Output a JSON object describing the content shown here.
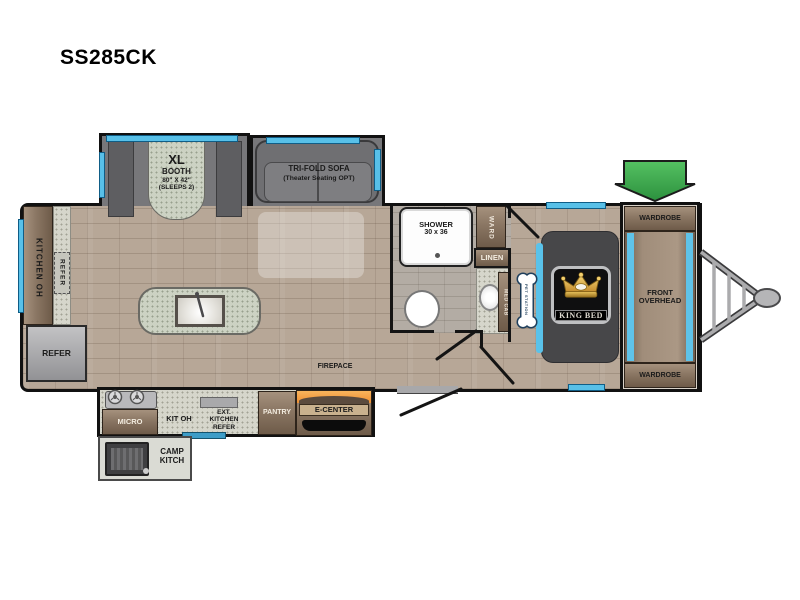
{
  "title": "SS285CK",
  "colors": {
    "window_blue": "#58c0e8",
    "docking_green": "#3fae49",
    "fireplace_orange": "#f5a04c",
    "crown_gold": "#d9a93c",
    "step_blue": "#3d9dc8",
    "wall_black": "#141414"
  },
  "plan": {
    "booth": {
      "l1": "XL",
      "l2": "BOOTH",
      "l3": "80\" X 42\"",
      "l4": "(SLEEPS 2)"
    },
    "sofa": {
      "l1": "TRI-FOLD SOFA",
      "l2": "(Theater Seating OPT)"
    },
    "shower": {
      "l1": "SHOWER",
      "l2": "30 x 36"
    },
    "ward": "WARD",
    "linen": "LINEN",
    "med_cab": "MED CAB",
    "pet_station": "PET STATION",
    "king_bed": "KING BED",
    "front_overhead": {
      "l1": "FRONT",
      "l2": "OVERHEAD"
    },
    "wardrobe_top": "WARDROBE",
    "wardrobe_bottom": "WARDROBE",
    "docking": {
      "l1": "DOCKING",
      "l2": "STATION"
    },
    "kitchen_oh": "KITCHEN OH",
    "refer_counter": "REFER",
    "refer_main": "REFER",
    "micro": "MICRO",
    "kit_oh": "KIT OH",
    "ext_kitchen": {
      "l1": "EXT.",
      "l2": "KITCHEN",
      "l3": "REFER"
    },
    "pantry": "PANTRY",
    "e_center": "E-CENTER",
    "fireplace": "FIREPACE",
    "camp_kitch": {
      "l1": "CAMP",
      "l2": "KITCH"
    }
  }
}
